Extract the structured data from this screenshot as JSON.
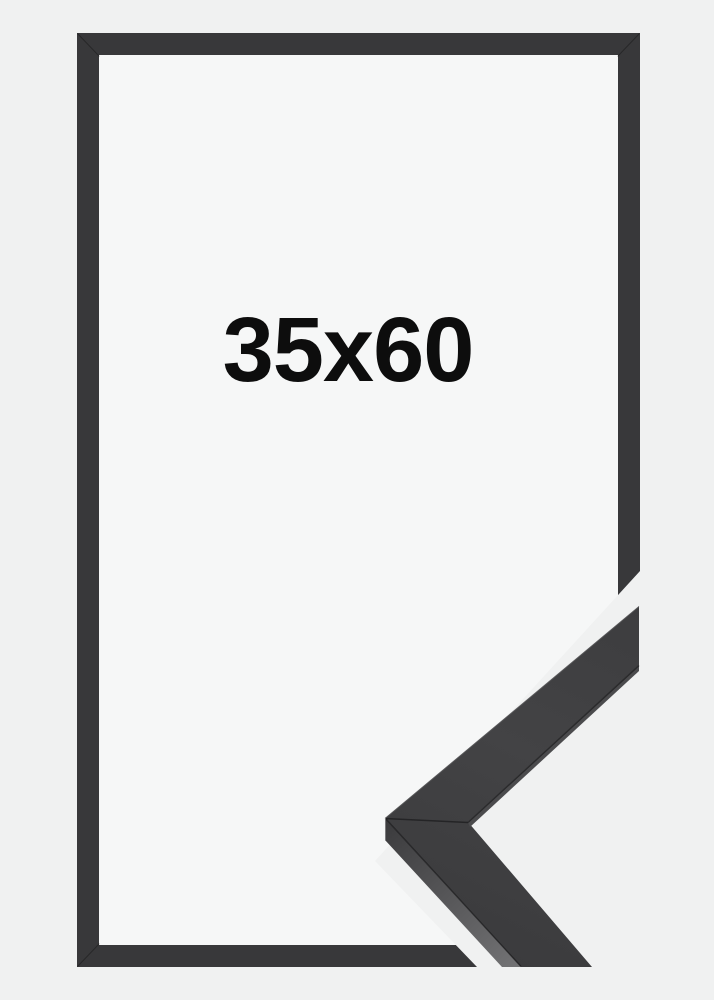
{
  "image": {
    "size_label": "35x60"
  },
  "corner_detail": {
    "description_name": "frame-corner-closeup"
  },
  "colors": {
    "background": "#f0f1f1",
    "frame_interior": "#f6f7f7",
    "frame": "#38383a",
    "corner_face": "#414143",
    "corner_side": "#5a5a5c",
    "seam": "#1c1c1e",
    "text": "#0d0d0d"
  }
}
